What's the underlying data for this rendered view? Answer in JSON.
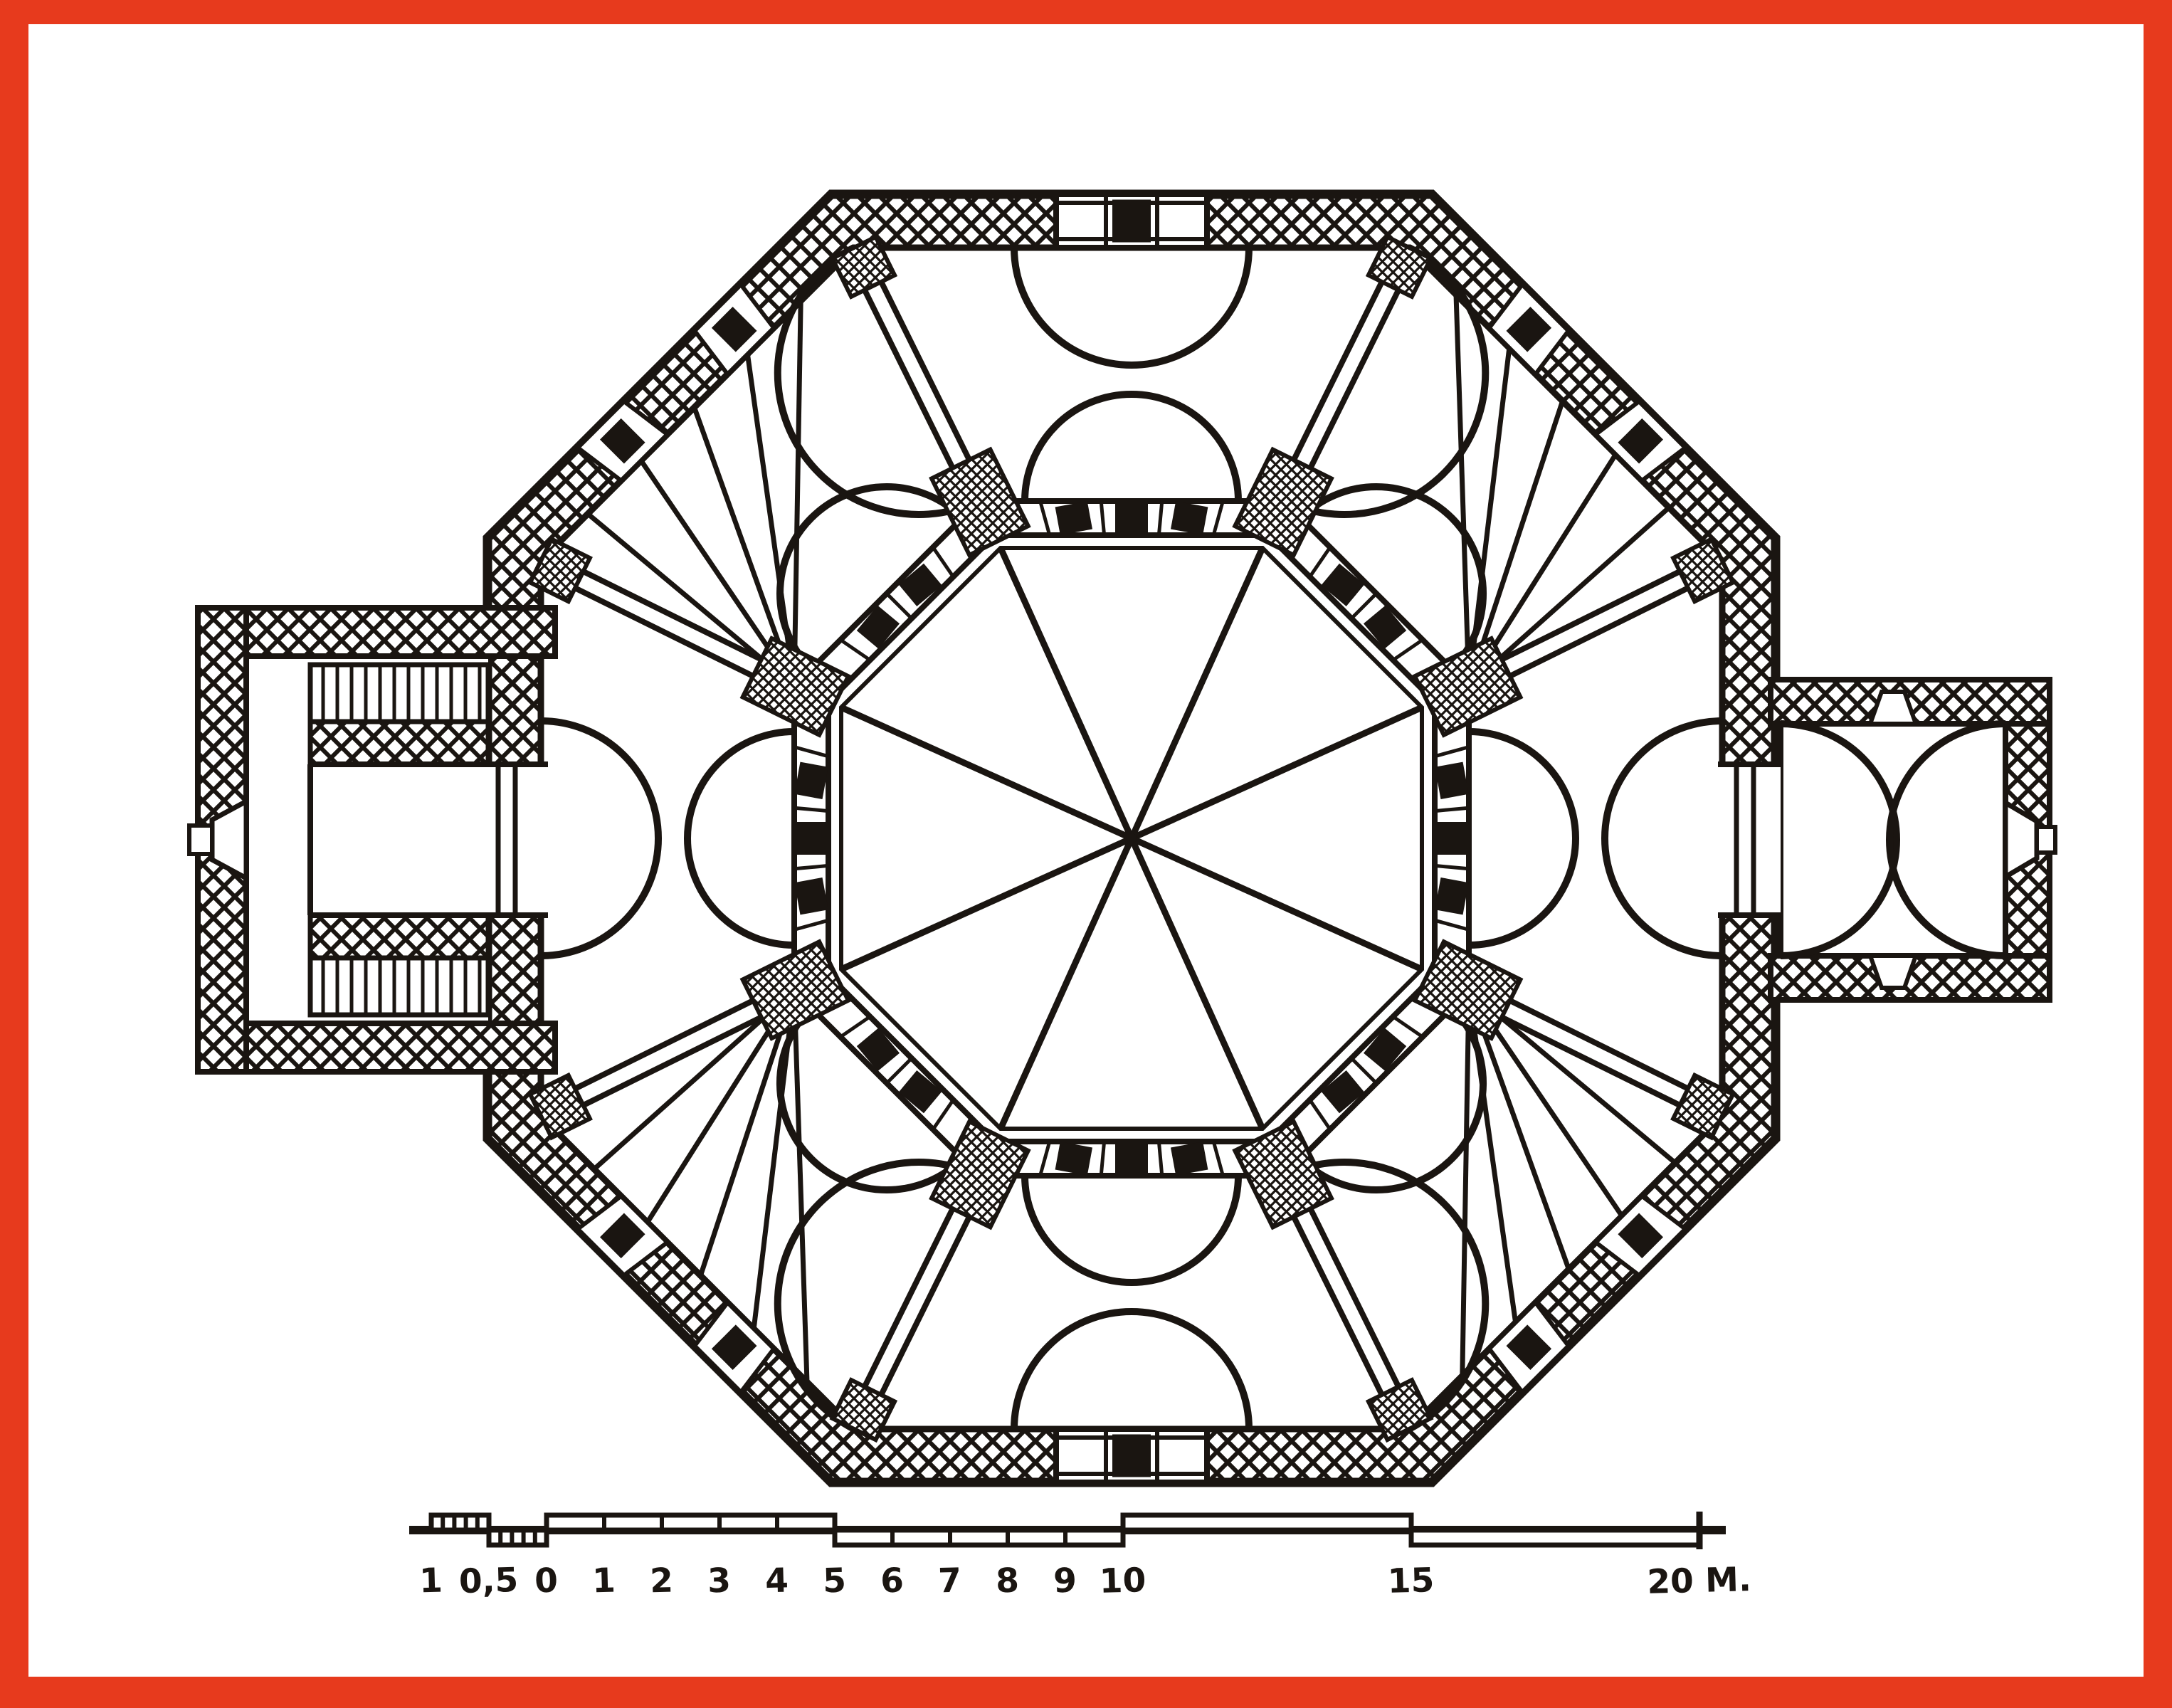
{
  "figure": {
    "kind": "architectural-floor-plan",
    "plan_shape": "octagon",
    "bays": 8,
    "fan_lines_per_corner_bay": 5,
    "windows_per_diagonal_wall": 2,
    "column_blocks_per_cardinal_screen": 3,
    "column_blocks_per_diagonal_screen": 2,
    "annex_left": "entrance hall with twin staircases and west door niche",
    "annex_right": "rectangular chamber with facing apse curves and east door niche"
  },
  "colors": {
    "frame": "#e73a1d",
    "paper": "#ffffff",
    "ink": "#1a1511"
  },
  "scale_bar": {
    "unit_suffix": "M.",
    "ticks": [
      {
        "label": "1",
        "u": -2
      },
      {
        "label": "0,5",
        "u": -1
      },
      {
        "label": "0",
        "u": 0
      },
      {
        "label": "1",
        "u": 1
      },
      {
        "label": "2",
        "u": 2
      },
      {
        "label": "3",
        "u": 3
      },
      {
        "label": "4",
        "u": 4
      },
      {
        "label": "5",
        "u": 5
      },
      {
        "label": "6",
        "u": 6
      },
      {
        "label": "7",
        "u": 7
      },
      {
        "label": "8",
        "u": 8
      },
      {
        "label": "9",
        "u": 9
      },
      {
        "label": "10",
        "u": 10
      },
      {
        "label": "15",
        "u": 15
      },
      {
        "label": "20 M.",
        "u": 20
      }
    ],
    "segments": [
      {
        "from": -2,
        "to": -1,
        "side": "above",
        "cells": 5
      },
      {
        "from": -1,
        "to": 0,
        "side": "below",
        "cells": 5
      },
      {
        "from": 0,
        "to": 5,
        "side": "above",
        "cells": 5
      },
      {
        "from": 5,
        "to": 10,
        "side": "below",
        "cells": 5
      },
      {
        "from": 10,
        "to": 15,
        "side": "above",
        "cells": 1
      },
      {
        "from": 15,
        "to": 20,
        "side": "below",
        "cells": 1
      }
    ]
  }
}
